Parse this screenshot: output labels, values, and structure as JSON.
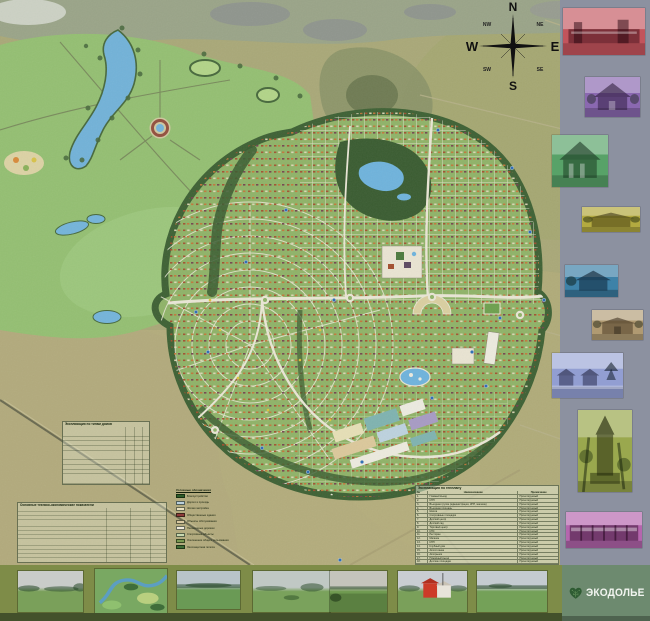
{
  "compass": {
    "n": "N",
    "s": "S",
    "e": "E",
    "w": "W",
    "ne": "NE",
    "nw": "NW",
    "se": "SE",
    "sw": "SW"
  },
  "logo": {
    "text": "ЭКОДОЛЬЕ"
  },
  "tables": {
    "house_types": {
      "title": "Экспликация по типам домов"
    },
    "tech_econ": {
      "title": "Основные технико-экономические показатели"
    },
    "genplan": {
      "title": "Экспликация по генплану",
      "columns": {
        "num": "№",
        "name": "Наименование",
        "note": "Примечание"
      },
      "rows": [
        {
          "num": "1.",
          "name": "Главный въезд",
          "note": "Проектируемый"
        },
        {
          "num": "2.",
          "name": "КПП",
          "note": "Проектируемый"
        },
        {
          "num": "3.",
          "name": "Въездная группа (администрация, КПП, магазин)",
          "note": "Проектируемый"
        },
        {
          "num": "4.",
          "name": "Въездная площадь",
          "note": "Проектируемый"
        },
        {
          "num": "5.",
          "name": "Школа",
          "note": "Проектируемый"
        },
        {
          "num": "6.",
          "name": "Спортивные площадки",
          "note": "Проектируемый"
        },
        {
          "num": "7.",
          "name": "Детский центр",
          "note": "Проектируемый"
        },
        {
          "num": "8.",
          "name": "Детский сад",
          "note": "Проектируемый"
        },
        {
          "num": "9.",
          "name": "Торговый центр",
          "note": "Проектируемый"
        },
        {
          "num": "10.",
          "name": "КНС",
          "note": "Проектируемый"
        },
        {
          "num": "11.",
          "name": "Ресторан",
          "note": "Проектируемый"
        },
        {
          "num": "12.",
          "name": "Магазин",
          "note": "Проектируемый"
        },
        {
          "num": "13.",
          "name": "КПП",
          "note": "Проектируемый"
        },
        {
          "num": "14.",
          "name": "Клубный дом",
          "note": "Проектируемый"
        },
        {
          "num": "15.",
          "name": "Автостоянка",
          "note": "Проектируемый"
        },
        {
          "num": "16.",
          "name": "Авторынок",
          "note": "Проектируемый"
        },
        {
          "num": "17.",
          "name": "Пожарный въезд",
          "note": "Проектируемый"
        },
        {
          "num": "18.",
          "name": "Детские площадки",
          "note": "Проектируемый"
        }
      ]
    }
  },
  "legend": {
    "title": "Условные обозначения",
    "items": [
      {
        "color": "#2e5c2a",
        "label": "Благоустройство"
      },
      {
        "color": "#b9cfdc",
        "label": "Дороги и проезды"
      },
      {
        "color": "#e9e1c1",
        "label": "Жилая застройка"
      },
      {
        "color": "#8e3b3a",
        "label": "Общественные здания"
      },
      {
        "color": "#d8c9a2",
        "label": "Объекты обслуживания"
      },
      {
        "color": "#efeadb",
        "label": "Пешеходные дорожки"
      },
      {
        "color": "#c7d8af",
        "label": "Спортивные объекты"
      },
      {
        "color": "#7a9a52",
        "label": "Озеленение общего пользования"
      },
      {
        "color": "#3f6d35",
        "label": "Лесозащитная полоса"
      }
    ]
  },
  "sidebar": {
    "thumbnails": [
      {
        "type": "long-building",
        "tint": "#c2545c"
      },
      {
        "type": "cottage",
        "tint": "#8a68b0"
      },
      {
        "type": "cottage",
        "tint": "#58a268"
      },
      {
        "type": "low-house",
        "tint": "#b3aa40"
      },
      {
        "type": "cottage",
        "tint": "#3e82a8"
      },
      {
        "type": "low-house",
        "tint": "#b09a72"
      },
      {
        "type": "street-view",
        "tint": "#929ed2"
      },
      {
        "type": "tower",
        "tint": "#9aa84e"
      },
      {
        "type": "terraced-houses",
        "tint": "#b566ae"
      }
    ]
  },
  "bottom": {
    "photos": [
      {
        "type": "meadow",
        "sky": "#c9ccc9",
        "ground": "#7aa05a"
      },
      {
        "type": "aerial-river-valley",
        "sky": "#8fba77",
        "ground": "#4f7e43"
      },
      {
        "type": "field",
        "sky": "#b8c4c8",
        "ground": "#6a9a55"
      },
      {
        "type": "field-bushes",
        "sky": "#c0c8c4",
        "ground": "#7aa25c"
      },
      {
        "type": "field",
        "sky": "#c4c4bc",
        "ground": "#6f9a50"
      },
      {
        "type": "red-farm-building",
        "sky": "#c9cdd2",
        "ground": "#7aa05a",
        "accent": "#cc3b28"
      },
      {
        "type": "field-treeline",
        "sky": "#c4cbd0",
        "ground": "#74a158"
      }
    ]
  },
  "colors": {
    "sidebar_bg": "#8c91a0",
    "bottom_band": "#7e8c48",
    "bottom_band_dark": "#43512b",
    "logo_panel_bg": "#6d8a6f",
    "water": "#6fb3dc",
    "forest": "#3e6134",
    "dev_area": "#8fb368",
    "park_green": "#94bf72",
    "aerial_base": "#a9a878",
    "road": "#e9e6d5"
  }
}
